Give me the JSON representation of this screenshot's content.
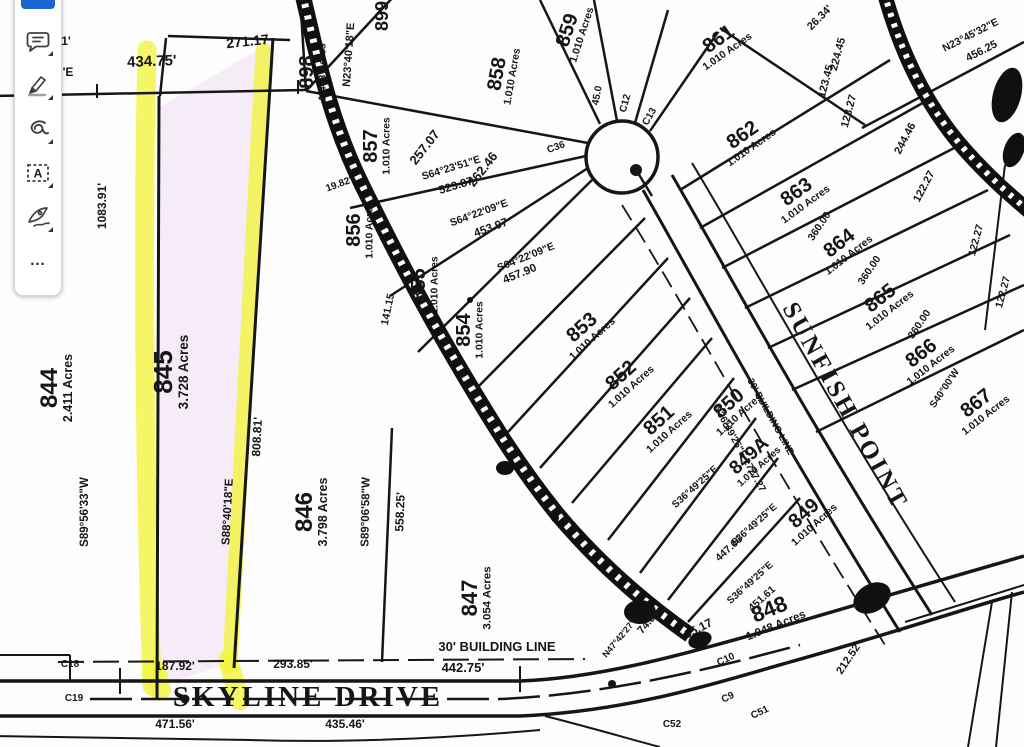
{
  "toolbar": {
    "items": [
      {
        "icon": "active-tool",
        "type": "selected-indicator"
      },
      {
        "icon": "comment-icon"
      },
      {
        "icon": "highlighter-icon"
      },
      {
        "icon": "freehand-draw-icon"
      },
      {
        "icon": "text-box-icon",
        "glyph": "A"
      },
      {
        "icon": "signature-icon"
      },
      {
        "icon": "more-tools-icon",
        "glyph": "…"
      }
    ],
    "more_glyph": "…",
    "textbox_glyph": "A"
  },
  "colors": {
    "highlight_yellow": "#f2f43e",
    "lot_tint_pink": "#f6ecf8",
    "accent_blue": "#1a66d0",
    "ink": "#161616"
  },
  "map": {
    "streets": [
      {
        "label": "SKYLINE DRIVE"
      },
      {
        "label": "SUNFISH POINT"
      }
    ],
    "lots": [
      {
        "number": "844",
        "acres": "2.411 Acres",
        "x": 57,
        "y": 388,
        "rot": -90,
        "ns": 24
      },
      {
        "number": "845",
        "acres": "3.728 Acres",
        "x": 172,
        "y": 372,
        "rot": -90,
        "ns": 26
      },
      {
        "number": "846",
        "acres": "3.798 Acres",
        "x": 312,
        "y": 512,
        "rot": -90,
        "ns": 24
      },
      {
        "number": "847",
        "acres": "3.054 Acres",
        "x": 477,
        "y": 598,
        "rot": -90,
        "ns": 22
      },
      {
        "number": "848",
        "acres": "1.048 Acres",
        "x": 772,
        "y": 616,
        "rot": -22,
        "ns": 22
      },
      {
        "number": "849",
        "acres": "1.010 Acres",
        "x": 808,
        "y": 518,
        "rot": -42,
        "ns": 20
      },
      {
        "number": "849A",
        "acres": "1.010 Acres",
        "x": 753,
        "y": 460,
        "rot": -42,
        "ns": 19
      },
      {
        "number": "850",
        "acres": "1.010 Acres",
        "x": 733,
        "y": 408,
        "rot": -42,
        "ns": 20
      },
      {
        "number": "851",
        "acres": "1.010 Acres",
        "x": 663,
        "y": 425,
        "rot": -42,
        "ns": 20
      },
      {
        "number": "852",
        "acres": "1.010 Acres",
        "x": 625,
        "y": 380,
        "rot": -42,
        "ns": 20
      },
      {
        "number": "853",
        "acres": "1.010 Acres",
        "x": 586,
        "y": 332,
        "rot": -42,
        "ns": 20
      },
      {
        "number": "854",
        "acres": "1.010 Acres",
        "x": 470,
        "y": 330,
        "rot": -90,
        "ns": 20
      },
      {
        "number": "855",
        "acres": "1.010 Acres",
        "x": 425,
        "y": 285,
        "rot": -90,
        "ns": 20
      },
      {
        "number": "856",
        "acres": "1.010 Acres",
        "x": 360,
        "y": 230,
        "rot": -90,
        "ns": 20
      },
      {
        "number": "857",
        "acres": "1.010 Acres",
        "x": 377,
        "y": 146,
        "rot": -90,
        "ns": 20
      },
      {
        "number": "858",
        "acres": "1.010 Acres",
        "x": 503,
        "y": 75,
        "rot": -80,
        "ns": 20
      },
      {
        "number": "859",
        "acres": "1.010 Acres",
        "x": 573,
        "y": 32,
        "rot": -72,
        "ns": 20
      },
      {
        "number": "861",
        "acres": "1.010 Acres",
        "x": 722,
        "y": 44,
        "rot": -35,
        "ns": 20
      },
      {
        "number": "862",
        "acres": "1.010 Acres",
        "x": 746,
        "y": 140,
        "rot": -35,
        "ns": 20
      },
      {
        "number": "863",
        "acres": "1.010 Acres",
        "x": 800,
        "y": 197,
        "rot": -36,
        "ns": 20
      },
      {
        "number": "864",
        "acres": "1.010 Acres",
        "x": 843,
        "y": 248,
        "rot": -38,
        "ns": 20
      },
      {
        "number": "865",
        "acres": "1.010 Acres",
        "x": 884,
        "y": 303,
        "rot": -38,
        "ns": 20
      },
      {
        "number": "866",
        "acres": "1.010 Acres",
        "x": 925,
        "y": 358,
        "rot": -38,
        "ns": 20
      },
      {
        "number": "867",
        "acres": "1.010 Acres",
        "x": 980,
        "y": 408,
        "rot": -38,
        "ns": 20
      },
      {
        "number": "898",
        "acres": "1.443 Acres",
        "x": 313,
        "y": 72,
        "rot": -90,
        "ns": 20
      },
      {
        "number": "899",
        "acres": "",
        "x": 388,
        "y": 16,
        "rot": -90,
        "ns": 18
      }
    ],
    "labels": [
      {
        "t": "434.75'",
        "x": 152,
        "y": 66,
        "r": -2,
        "s": 15
      },
      {
        "t": "271.17",
        "x": 248,
        "y": 46,
        "r": -6,
        "s": 14
      },
      {
        "t": "1'",
        "x": 66,
        "y": 45,
        "r": 0,
        "s": 12
      },
      {
        "t": "'E",
        "x": 68,
        "y": 76,
        "r": 0,
        "s": 12
      },
      {
        "t": "1083.91'",
        "x": 106,
        "y": 206,
        "r": -90,
        "s": 12
      },
      {
        "t": "S89°56'33\"W",
        "x": 88,
        "y": 512,
        "r": -90,
        "s": 11.5
      },
      {
        "t": "808.81'",
        "x": 261,
        "y": 437,
        "r": -87,
        "s": 12
      },
      {
        "t": "S88°40'18\"E",
        "x": 231,
        "y": 512,
        "r": -87,
        "s": 11.5
      },
      {
        "t": "S89°06'58\"W",
        "x": 369,
        "y": 512,
        "r": -89,
        "s": 11.5
      },
      {
        "t": "558.25'",
        "x": 404,
        "y": 512,
        "r": -88,
        "s": 12
      },
      {
        "t": "N23°40'18\"E",
        "x": 352,
        "y": 55,
        "r": -86,
        "s": 11
      },
      {
        "t": "257.07",
        "x": 428,
        "y": 150,
        "r": -52,
        "s": 13
      },
      {
        "t": "262.46",
        "x": 486,
        "y": 172,
        "r": -52,
        "s": 13
      },
      {
        "t": "S64°23'51\"E",
        "x": 452,
        "y": 171,
        "r": -17,
        "s": 10.5
      },
      {
        "t": "523.87",
        "x": 457,
        "y": 189,
        "r": -17,
        "s": 11.5
      },
      {
        "t": "S64°22'09\"E",
        "x": 480,
        "y": 216,
        "r": -20,
        "s": 10.5
      },
      {
        "t": "453.97",
        "x": 492,
        "y": 231,
        "r": -20,
        "s": 11.5
      },
      {
        "t": "S64°22'09\"E",
        "x": 527,
        "y": 260,
        "r": -22,
        "s": 10.5
      },
      {
        "t": "457.90",
        "x": 521,
        "y": 277,
        "r": -22,
        "s": 11.5
      },
      {
        "t": "19.82'",
        "x": 340,
        "y": 187,
        "r": -20,
        "s": 10
      },
      {
        "t": "141.15",
        "x": 391,
        "y": 310,
        "r": -78,
        "s": 10.5
      },
      {
        "t": "45.0",
        "x": 600,
        "y": 96,
        "r": -80,
        "s": 10
      },
      {
        "t": "C36",
        "x": 557,
        "y": 150,
        "r": -20,
        "s": 10
      },
      {
        "t": "C13",
        "x": 652,
        "y": 118,
        "r": -60,
        "s": 10
      },
      {
        "t": "C12",
        "x": 628,
        "y": 104,
        "r": -75,
        "s": 10
      },
      {
        "t": "30' BUILDING LINE",
        "x": 497,
        "y": 651,
        "r": 0,
        "s": 13
      },
      {
        "t": "442.75'",
        "x": 463,
        "y": 672,
        "r": 0,
        "s": 13
      },
      {
        "t": "187.92'",
        "x": 175,
        "y": 670,
        "r": 0,
        "s": 12
      },
      {
        "t": "293.85'",
        "x": 293,
        "y": 668,
        "r": 0,
        "s": 12
      },
      {
        "t": "471.56'",
        "x": 175,
        "y": 728,
        "r": 0,
        "s": 12
      },
      {
        "t": "435.46'",
        "x": 345,
        "y": 728,
        "r": 0,
        "s": 12
      },
      {
        "t": "C18",
        "x": 70,
        "y": 667,
        "r": 0,
        "s": 10
      },
      {
        "t": "C19",
        "x": 74,
        "y": 701,
        "r": 0,
        "s": 10
      },
      {
        "t": "C52",
        "x": 672,
        "y": 727,
        "r": 0,
        "s": 10
      },
      {
        "t": "C9",
        "x": 729,
        "y": 700,
        "r": -25,
        "s": 10
      },
      {
        "t": "C10",
        "x": 727,
        "y": 662,
        "r": -25,
        "s": 10
      },
      {
        "t": "C51",
        "x": 761,
        "y": 715,
        "r": -25,
        "s": 10
      },
      {
        "t": "65.17",
        "x": 700,
        "y": 632,
        "r": -27,
        "s": 12
      },
      {
        "t": "74.56",
        "x": 651,
        "y": 624,
        "r": -50,
        "s": 11
      },
      {
        "t": "N47°42'27\"W",
        "x": 624,
        "y": 637,
        "r": -50,
        "s": 9
      },
      {
        "t": "212.52",
        "x": 851,
        "y": 661,
        "r": -56,
        "s": 11
      },
      {
        "t": "S36°49'25\"E",
        "x": 697,
        "y": 489,
        "r": -42,
        "s": 10
      },
      {
        "t": "S36°49'25\"E",
        "x": 756,
        "y": 527,
        "r": -42,
        "s": 10
      },
      {
        "t": "447.66",
        "x": 731,
        "y": 551,
        "r": -42,
        "s": 10.5
      },
      {
        "t": "S36°49'25\"E",
        "x": 752,
        "y": 585,
        "r": -42,
        "s": 10
      },
      {
        "t": "451.61",
        "x": 764,
        "y": 601,
        "r": -42,
        "s": 10.5
      },
      {
        "t": "N36°49'25\"E  1727.27",
        "x": 737,
        "y": 450,
        "r": 61,
        "s": 10
      },
      {
        "t": "30' BUILDING LINE",
        "x": 768,
        "y": 418,
        "r": 61,
        "s": 9.5
      },
      {
        "t": "26.34'",
        "x": 822,
        "y": 20,
        "r": -45,
        "s": 11
      },
      {
        "t": "N23°45'32\"E",
        "x": 972,
        "y": 38,
        "r": -27,
        "s": 10.5
      },
      {
        "t": "456.25",
        "x": 983,
        "y": 54,
        "r": -27,
        "s": 11
      },
      {
        "t": "224.45",
        "x": 841,
        "y": 55,
        "r": -75,
        "s": 11
      },
      {
        "t": "123.45",
        "x": 829,
        "y": 82,
        "r": -75,
        "s": 11
      },
      {
        "t": "123.27",
        "x": 852,
        "y": 112,
        "r": -75,
        "s": 11
      },
      {
        "t": "244.46",
        "x": 908,
        "y": 140,
        "r": -62,
        "s": 11
      },
      {
        "t": "122.27",
        "x": 927,
        "y": 188,
        "r": -62,
        "s": 11
      },
      {
        "t": "360.00",
        "x": 822,
        "y": 228,
        "r": -56,
        "s": 10.5
      },
      {
        "t": "360.00",
        "x": 872,
        "y": 272,
        "r": -56,
        "s": 10.5
      },
      {
        "t": "360.00",
        "x": 922,
        "y": 326,
        "r": -56,
        "s": 10.5
      },
      {
        "t": "122.27",
        "x": 979,
        "y": 241,
        "r": -75,
        "s": 10.5
      },
      {
        "t": "122.27",
        "x": 1006,
        "y": 293,
        "r": -75,
        "s": 10.5
      },
      {
        "t": "S40°00'W",
        "x": 947,
        "y": 390,
        "r": -56,
        "s": 10
      }
    ]
  }
}
